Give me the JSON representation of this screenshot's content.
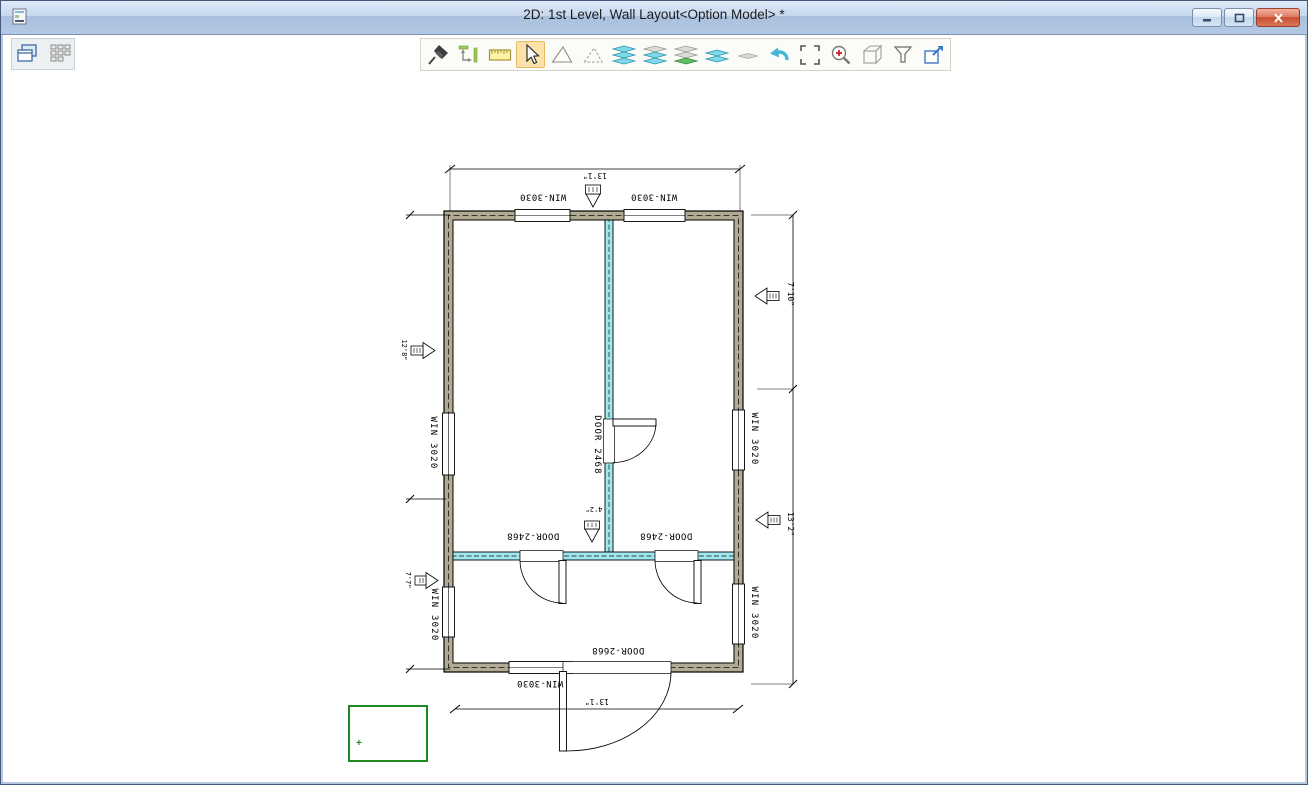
{
  "window": {
    "title": "2D: 1st Level, Wall Layout<Option Model> *",
    "controls": [
      {
        "icon": "minimize-icon"
      },
      {
        "icon": "restore-icon"
      },
      {
        "icon": "close-icon"
      }
    ]
  },
  "toolbars": {
    "window_tools": [
      {
        "icon": "cascade-windows-icon"
      },
      {
        "icon": "tile-windows-icon"
      }
    ],
    "main_tools": [
      {
        "icon": "pin-icon"
      },
      {
        "icon": "measure-icon"
      },
      {
        "icon": "ruler-icon"
      },
      {
        "icon": "select-cursor-icon",
        "selected": true
      },
      {
        "icon": "polygon-icon"
      },
      {
        "icon": "polygon-dashed-icon"
      },
      {
        "icon": "layers-stack-icon"
      },
      {
        "icon": "layers-stack-alt-icon"
      },
      {
        "icon": "layers-green-icon"
      },
      {
        "icon": "layers-two-icon"
      },
      {
        "icon": "layer-flat-icon"
      },
      {
        "icon": "undo-icon"
      },
      {
        "icon": "zoom-extents-icon"
      },
      {
        "icon": "zoom-in-icon"
      },
      {
        "icon": "box-3d-icon"
      },
      {
        "icon": "filter-icon"
      },
      {
        "icon": "export-view-icon"
      }
    ]
  },
  "plan": {
    "view_rotation_deg": 180,
    "labels": {
      "top_window_left": "WIN-3030",
      "top_window_right": "WIN-3030",
      "bottom_window": "WIN-3030",
      "entry_door": "DOOR-2668",
      "hall_door_left": "DOOR-2468",
      "hall_door_right": "DOOR-2468",
      "center_door": "DOOR 2468",
      "left_window_upper": "WIN 3020",
      "left_window_lower": "WIN 3020",
      "right_window_upper": "WIN 3020",
      "right_window_lower": "WIN 3020"
    },
    "dims": {
      "overall_top": "13'1\"",
      "overall_bottom": "13'1\"",
      "right_upper": "7'10\"",
      "right_lower": "13'2\"",
      "left_upper": "12'8\"",
      "left_lower": "7'7\"",
      "interior": "4'2\""
    },
    "colors": {
      "exterior_wall_fill": "#b2aa92",
      "interior_wall_fill": "#9fe8f0",
      "annotation_green": "#1f8a1f"
    }
  }
}
